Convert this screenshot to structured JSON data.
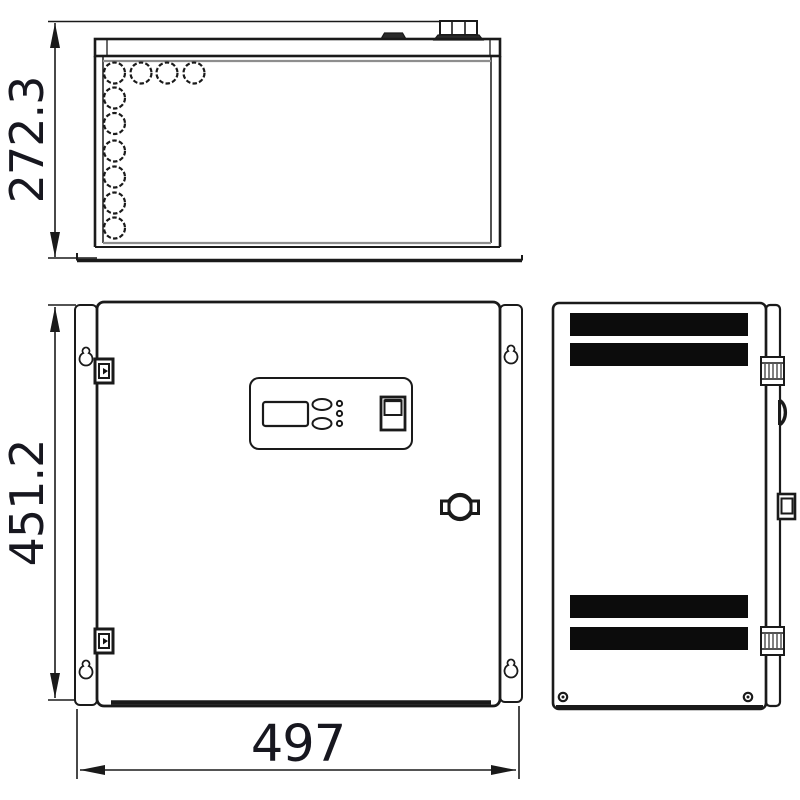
{
  "drawing": {
    "type": "enclosure-three-view-technical-drawing",
    "background_color": "#ffffff",
    "line_color": "#1a1a1a",
    "thin_line_color": "#8e8e8e",
    "accent_fill_color": "#0c0c0c",
    "dim_text_color": "#17171f",
    "dimensions": {
      "depth_label": "272.3",
      "height_label": "451.2",
      "width_label": "497"
    },
    "views": {
      "top_view": "top view with knockout holes and cable gland",
      "front_view": "front view with door, control panel and cam lock",
      "side_view": "side view with ventilation slots and hinges"
    },
    "icons": {
      "knockout_hole": "dashed-circle",
      "cable_gland": "stepped-block",
      "keyhole_mount_slot": "teardrop",
      "door_hinge": "knurled-rect",
      "cam_lock": "circle-with-side-tabs",
      "vent_slot": "solid-black-bar",
      "screw": "ring-with-dot",
      "dim_arrow": "slender-filled-triangle"
    }
  }
}
